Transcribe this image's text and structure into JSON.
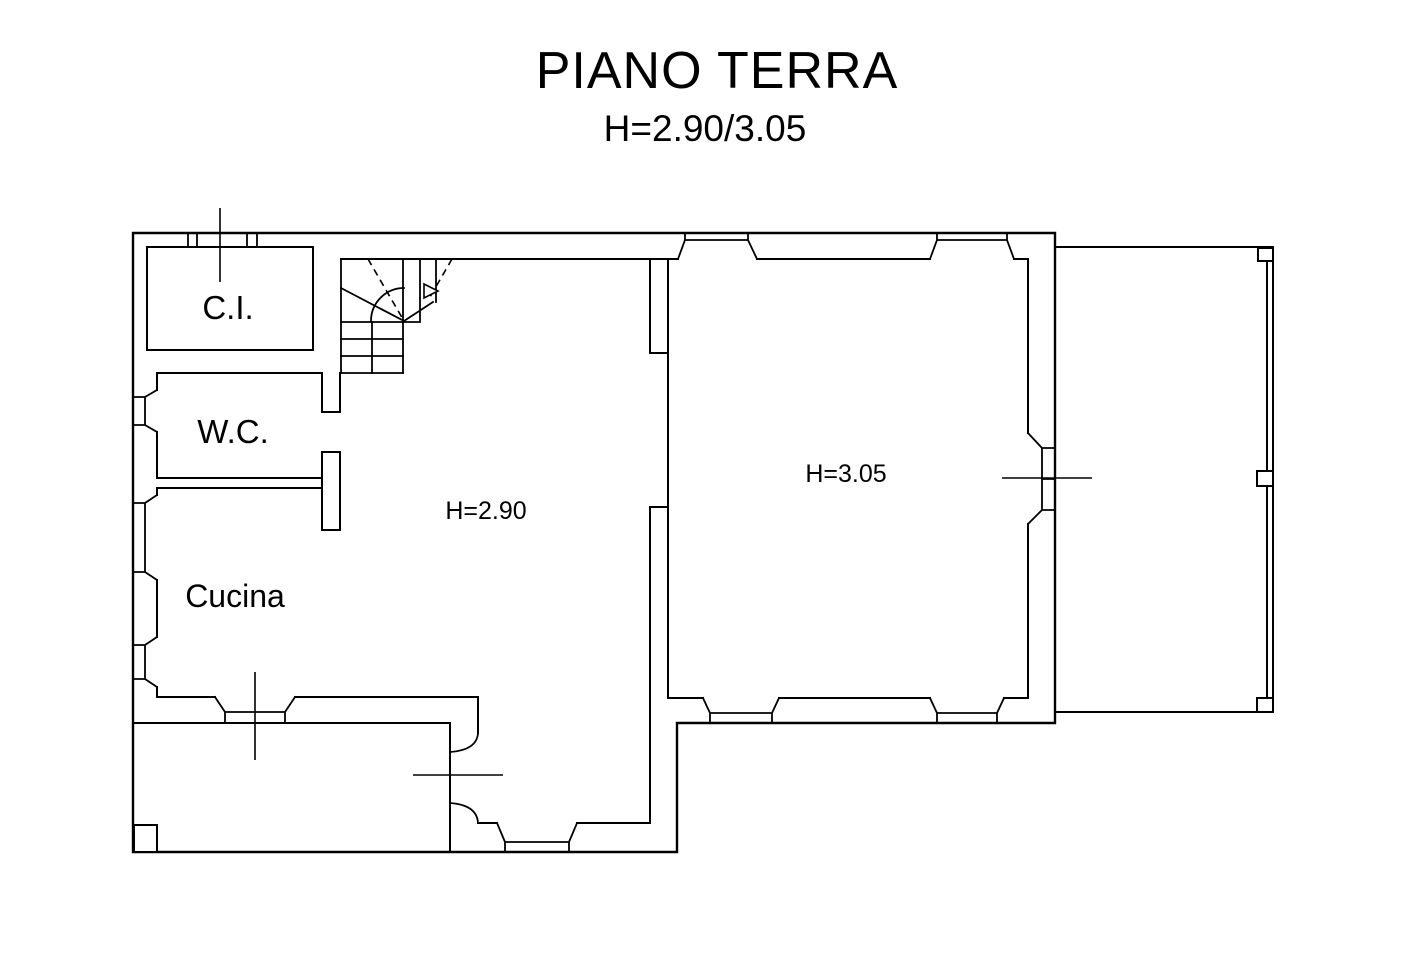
{
  "title": "PIANO TERRA",
  "subtitle": "H=2.90/3.05",
  "rooms": {
    "ci": {
      "label": "C.I."
    },
    "wc": {
      "label": "W.C."
    },
    "cucina": {
      "label": "Cucina"
    },
    "central": {
      "height_label": "H=2.90"
    },
    "main_right": {
      "height_label": "H=3.05"
    }
  },
  "colors": {
    "line": "#000000",
    "background": "#ffffff"
  }
}
